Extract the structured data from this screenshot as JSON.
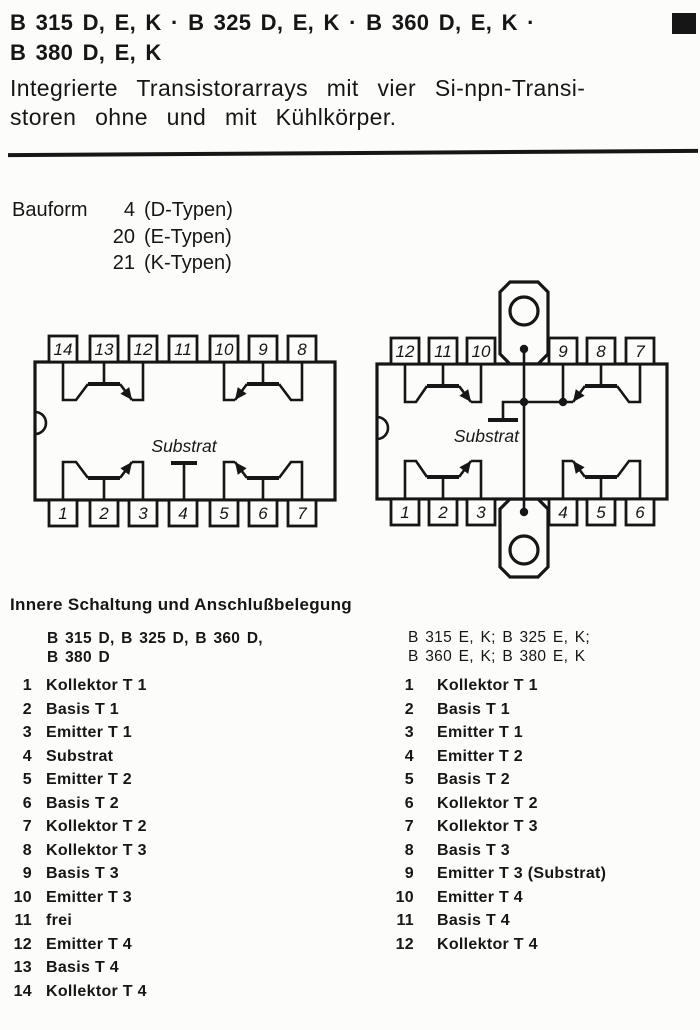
{
  "header": {
    "title_line1": "B 315 D, E, K · B 325 D, E, K · B 360 D, E, K ·",
    "title_line2": "B 380 D, E, K",
    "subtitle_line1": "Integrierte Transistorarrays mit vier Si-npn-Transi-",
    "subtitle_line2": "storen ohne und mit Kühlkörper."
  },
  "colors": {
    "ink": "#161616",
    "paper": "#fcfcfa"
  },
  "bauform": {
    "label": "Bauform",
    "entries": [
      {
        "num": "4",
        "desc": "(D-Typen)"
      },
      {
        "num": "20",
        "desc": "(E-Typen)"
      },
      {
        "num": "21",
        "desc": "(K-Typen)"
      }
    ]
  },
  "diagram_left": {
    "top_pins": [
      "14",
      "13",
      "12",
      "11",
      "10",
      "9",
      "8"
    ],
    "bottom_pins": [
      "1",
      "2",
      "3",
      "4",
      "5",
      "6",
      "7"
    ],
    "substrate_label": "Substrat"
  },
  "diagram_right": {
    "top_pins": [
      "12",
      "11",
      "10",
      "9",
      "8",
      "7"
    ],
    "bottom_pins": [
      "1",
      "2",
      "3",
      "4",
      "5",
      "6"
    ],
    "substrate_label": "Substrat"
  },
  "pinout": {
    "heading": "Innere Schaltung und Anschlußbelegung",
    "left": {
      "title_line1": "B 315 D, B 325 D, B 360 D,",
      "title_line2": "B 380 D",
      "pins": [
        {
          "num": "1",
          "label": "Kollektor T 1"
        },
        {
          "num": "2",
          "label": "Basis T 1"
        },
        {
          "num": "3",
          "label": "Emitter T 1"
        },
        {
          "num": "4",
          "label": "Substrat"
        },
        {
          "num": "5",
          "label": "Emitter T 2"
        },
        {
          "num": "6",
          "label": "Basis T 2"
        },
        {
          "num": "7",
          "label": "Kollektor T 2"
        },
        {
          "num": "8",
          "label": "Kollektor T 3"
        },
        {
          "num": "9",
          "label": "Basis T 3"
        },
        {
          "num": "10",
          "label": "Emitter T 3"
        },
        {
          "num": "11",
          "label": "frei"
        },
        {
          "num": "12",
          "label": "Emitter T 4"
        },
        {
          "num": "13",
          "label": "Basis T 4"
        },
        {
          "num": "14",
          "label": "Kollektor T 4"
        }
      ]
    },
    "right": {
      "title_line1": "B 315 E, K; B 325 E, K;",
      "title_line2": "B 360 E, K; B 380 E, K",
      "pins": [
        {
          "num": "1",
          "label": "Kollektor T 1"
        },
        {
          "num": "2",
          "label": "Basis T 1"
        },
        {
          "num": "3",
          "label": "Emitter T 1"
        },
        {
          "num": "4",
          "label": "Emitter T 2"
        },
        {
          "num": "5",
          "label": "Basis T 2"
        },
        {
          "num": "6",
          "label": "Kollektor T 2"
        },
        {
          "num": "7",
          "label": "Kollektor T 3"
        },
        {
          "num": "8",
          "label": "Basis T 3"
        },
        {
          "num": "9",
          "label": "Emitter T 3 (Substrat)"
        },
        {
          "num": "10",
          "label": "Emitter T 4"
        },
        {
          "num": "11",
          "label": "Basis T 4"
        },
        {
          "num": "12",
          "label": "Kollektor T 4"
        }
      ]
    }
  }
}
